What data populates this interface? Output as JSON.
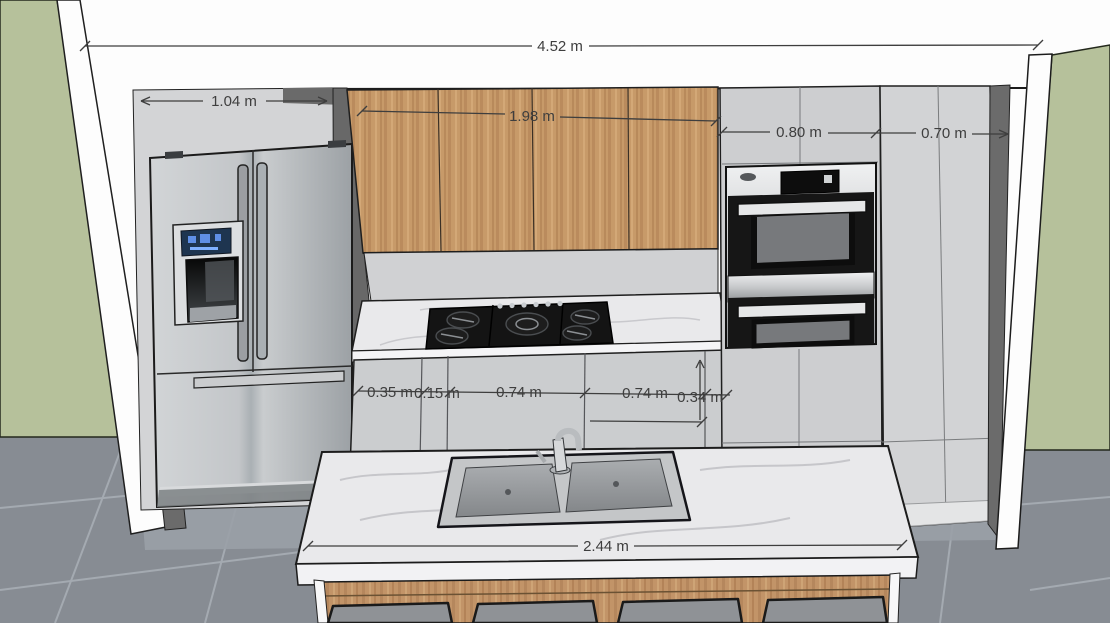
{
  "view": {
    "type": "3d-kitchen-elevation-render",
    "unit": "m"
  },
  "dimensions": {
    "total_width": "4.52 m",
    "fridge_alcove_width": "1.04 m",
    "upper_cabinet_width": "1.98 m",
    "oven_cabinet_width": "0.80 m",
    "tall_cabinet_width": "0.70 m",
    "base_cabinet_segments": [
      "0.35 m",
      "0.15 m",
      "0.74 m",
      "0.74 m",
      "0.34 m"
    ],
    "island_length": "2.44 m"
  },
  "objects": {
    "refrigerator": "french-door refrigerator with ice-water dispenser",
    "wall_oven": "stainless double wall oven",
    "cooktop": "5-burner gas cooktop",
    "sink": "double-bowl island sink with faucet",
    "stool_count": 4
  },
  "colors": {
    "wall_green": "#b6c19b",
    "soffit_white": "#fdfdfd",
    "wall_dark_gray": "#6b6b6b",
    "cabinet_light_gray": "#cccdd0",
    "cabinet_wood": "#c79a69",
    "counter_marble": "#e9e9eb",
    "appliance_black": "#161616",
    "appliance_steel": "#c7c9cb",
    "floor_tile_gray": "#878c93",
    "dimension_ink": "#3e3e3e",
    "dispenser_display_blue": "#2f5fae"
  }
}
